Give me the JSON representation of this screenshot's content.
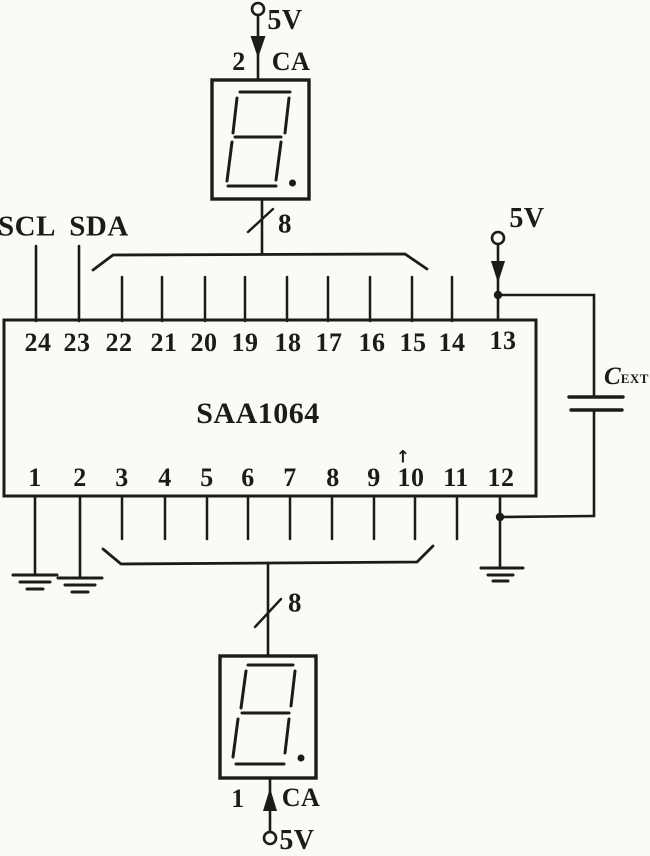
{
  "schematic": {
    "ic": {
      "part_number": "SAA1064",
      "top_pins": [
        "24",
        "23",
        "22",
        "21",
        "20",
        "19",
        "18",
        "17",
        "16",
        "15",
        "14",
        "13"
      ],
      "bottom_pins": [
        "1",
        "2",
        "3",
        "4",
        "5",
        "6",
        "7",
        "8",
        "9",
        "10",
        "11",
        "12"
      ],
      "pin10_mark": "↑"
    },
    "io": {
      "scl": "SCL",
      "sda": "SDA"
    },
    "supplies": {
      "top": "5V",
      "right": "5V",
      "bottom": "5V"
    },
    "displays": {
      "top": {
        "pin": "2",
        "anode": "CA",
        "digit": "8."
      },
      "bottom": {
        "pin": "1",
        "anode": "CA",
        "digit": "8."
      }
    },
    "buses": {
      "top_width": "8",
      "bottom_width": "8"
    },
    "capacitor": {
      "name": "C",
      "subscript": "EXT"
    },
    "colors": {
      "ink": "#1b1b1b",
      "paper": "#fbfaf6"
    }
  }
}
